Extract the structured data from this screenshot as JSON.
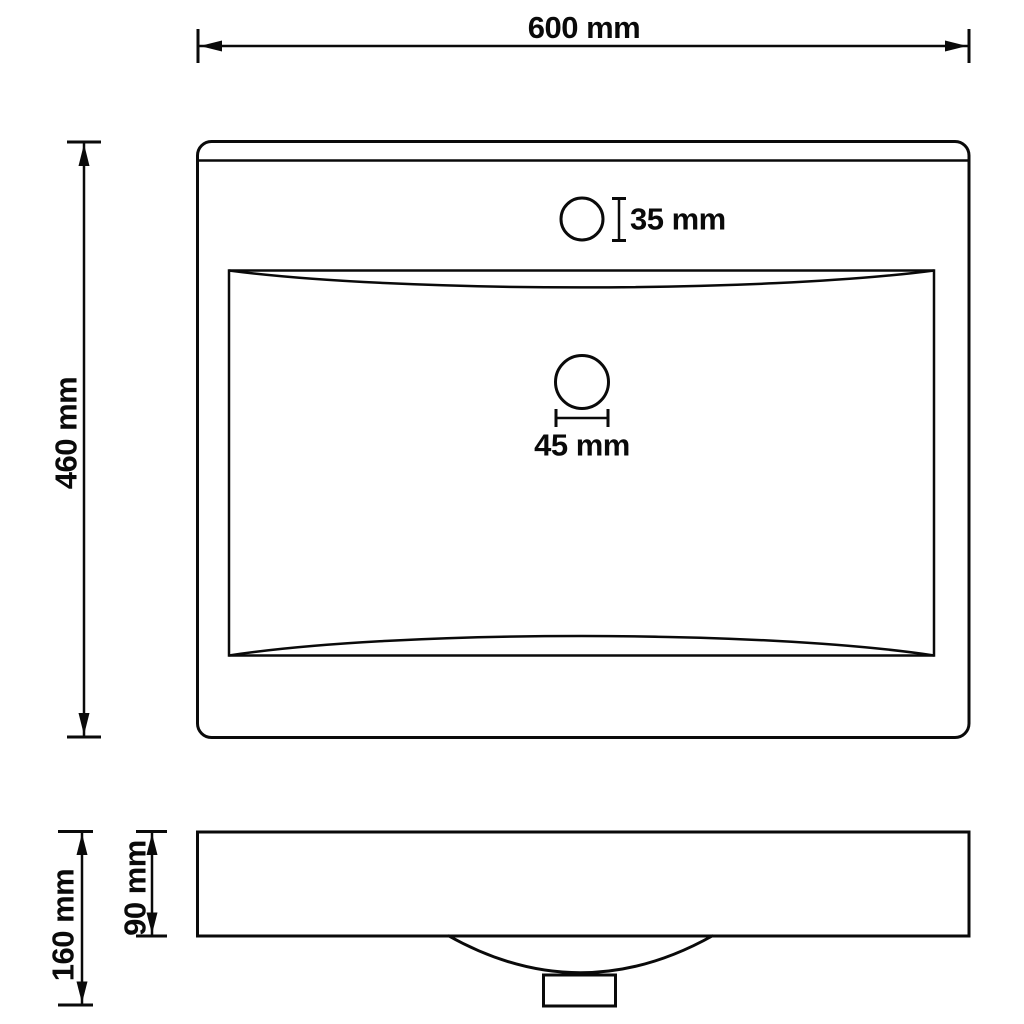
{
  "diagram": {
    "type": "technical-dimension-drawing",
    "subject": "rectangular wash basin, top view and side view",
    "colors": {
      "line": "#0a0a0a",
      "background": "#ffffff"
    },
    "top_view": {
      "width_label": "600 mm",
      "width_mm": 600,
      "height_label": "460 mm",
      "height_mm": 460,
      "faucet_hole_label": "35 mm",
      "faucet_hole_mm": 35,
      "drain_hole_label": "45 mm",
      "drain_hole_mm": 45
    },
    "side_view": {
      "total_height_label": "160 mm",
      "total_height_mm": 160,
      "rim_depth_label": "90 mm",
      "rim_depth_mm": 90
    }
  }
}
